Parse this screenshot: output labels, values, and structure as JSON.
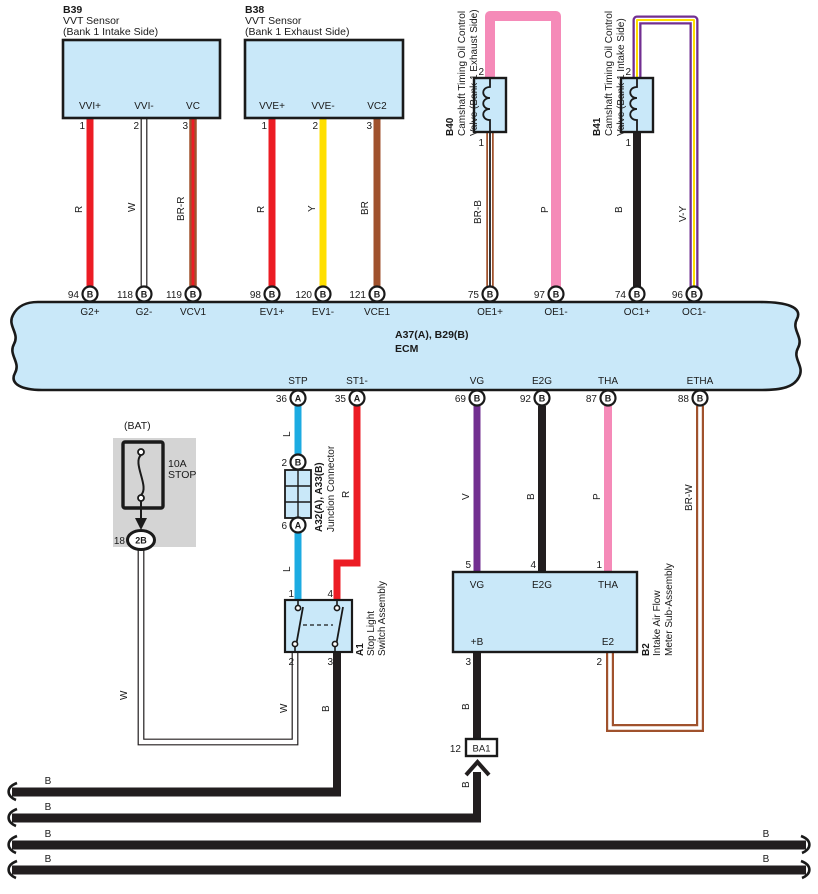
{
  "diagram": {
    "colors": {
      "component_fill": "#c9e8f9",
      "outline": "#1a1a1a",
      "gray": "#d4d4d4",
      "red": "#ec1c24",
      "yellow": "#ffdf00",
      "brown": "#a0522d",
      "pink": "#f58ab8",
      "blue": "#1cabe2",
      "violet": "#722f91",
      "black": "#221e1f",
      "white": "#ffffff"
    },
    "b39": {
      "code": "B39",
      "name": "VVT Sensor",
      "sub": "(Bank 1 Intake Side)",
      "pins": [
        {
          "n": "1",
          "label": "VVI+"
        },
        {
          "n": "2",
          "label": "VVI-"
        },
        {
          "n": "3",
          "label": "VC"
        }
      ]
    },
    "b38": {
      "code": "B38",
      "name": "VVT Sensor",
      "sub": "(Bank 1 Exhaust Side)",
      "pins": [
        {
          "n": "1",
          "label": "VVE+"
        },
        {
          "n": "2",
          "label": "VVE-"
        },
        {
          "n": "3",
          "label": "VC2"
        }
      ]
    },
    "b40": {
      "code": "B40",
      "line1": "Camshaft Timing Oil Control",
      "line2": "Valve (Bank 1 Exhaust Side)",
      "pin_top": "2",
      "pin_bottom": "1"
    },
    "b41": {
      "code": "B41",
      "line1": "Camshaft Timing Oil Control",
      "line2": "Valve (Bank 1 Intake Side)",
      "pin_top": "2",
      "pin_bottom": "1"
    },
    "ecm": {
      "code": "A37(A), B29(B)",
      "name": "ECM",
      "top_pins": [
        {
          "num": "94",
          "conn": "B",
          "label": "G2+"
        },
        {
          "num": "118",
          "conn": "B",
          "label": "G2-"
        },
        {
          "num": "119",
          "conn": "B",
          "label": "VCV1"
        },
        {
          "num": "98",
          "conn": "B",
          "label": "EV1+"
        },
        {
          "num": "120",
          "conn": "B",
          "label": "EV1-"
        },
        {
          "num": "121",
          "conn": "B",
          "label": "VCE1"
        },
        {
          "num": "75",
          "conn": "B",
          "label": "OE1+"
        },
        {
          "num": "97",
          "conn": "B",
          "label": "OE1-"
        },
        {
          "num": "74",
          "conn": "B",
          "label": "OC1+"
        },
        {
          "num": "96",
          "conn": "B",
          "label": "OC1-"
        }
      ],
      "bottom_pins": [
        {
          "num": "36",
          "conn": "A",
          "label": "STP"
        },
        {
          "num": "35",
          "conn": "A",
          "label": "ST1-"
        },
        {
          "num": "69",
          "conn": "B",
          "label": "VG"
        },
        {
          "num": "92",
          "conn": "B",
          "label": "E2G"
        },
        {
          "num": "87",
          "conn": "B",
          "label": "THA"
        },
        {
          "num": "88",
          "conn": "B",
          "label": "ETHA"
        }
      ]
    },
    "fuse": {
      "title": "(BAT)",
      "rating": "10A",
      "name": "STOP",
      "pin": "18",
      "conn": "2B"
    },
    "junction": {
      "code": "A32(A), A33(B)",
      "name": "Junction Connector",
      "pin_top": "2",
      "conn_top": "B",
      "pin_bottom": "6",
      "conn_bottom": "A"
    },
    "a1": {
      "code": "A1",
      "line1": "Stop Light",
      "line2": "Switch Assembly",
      "pin_tl": "1",
      "pin_tr": "4",
      "pin_bl": "2",
      "pin_br": "3"
    },
    "b2": {
      "code": "B2",
      "line1": "Intake Air Flow",
      "line2": "Meter Sub-Assembly",
      "top_pins": [
        {
          "n": "5",
          "label": "VG"
        },
        {
          "n": "4",
          "label": "E2G"
        },
        {
          "n": "1",
          "label": "THA"
        }
      ],
      "bottom_pins": [
        {
          "n": "3",
          "label": "+B"
        },
        {
          "n": "2",
          "label": "E2"
        }
      ]
    },
    "ba1": {
      "pin": "12",
      "label": "BA1"
    },
    "wire_labels": {
      "g2p": "R",
      "g2m": "W",
      "vcv1": "BR-R",
      "ev1p": "R",
      "ev1m": "Y",
      "vce1": "BR",
      "oe1p": "BR-B",
      "oe1m": "P",
      "oc1p": "B",
      "oc1m": "V-Y",
      "stp_upper": "L",
      "st1": "R",
      "stp_lower": "L",
      "vg": "V",
      "e2g": "B",
      "tha": "P",
      "etha": "BR-W",
      "fuse_w": "W",
      "sw2_w": "W",
      "sw3_b": "B",
      "plusb_b": "B",
      "ba1_b": "B",
      "bus1": "B",
      "bus2": "B",
      "bus3": "B",
      "bus4": "B",
      "bus3r": "B",
      "bus4r": "B"
    }
  }
}
